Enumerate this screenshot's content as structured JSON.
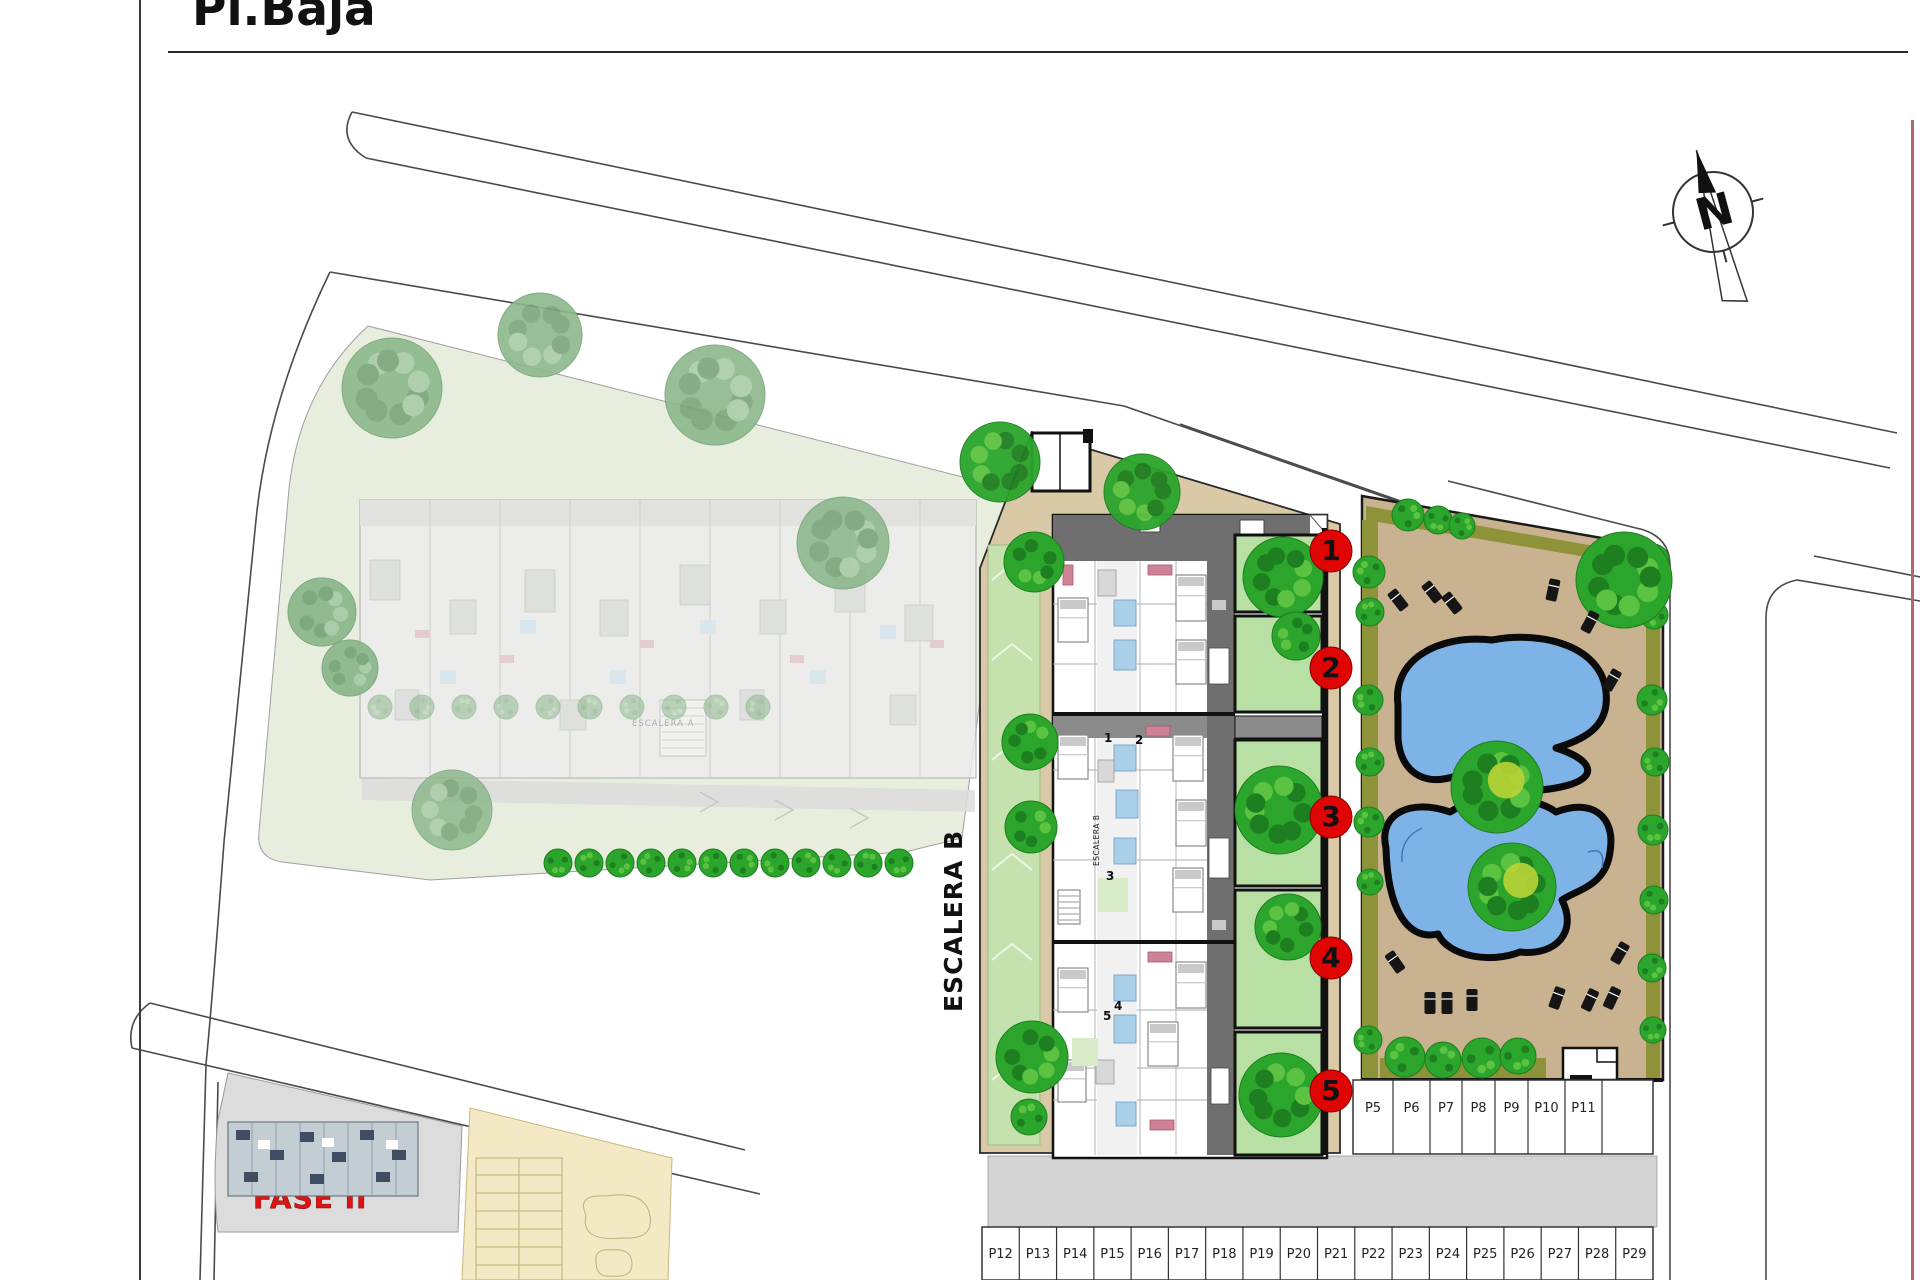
{
  "title": {
    "text": "Pl.Baja"
  },
  "plan": {
    "building_label_large": "ESCALERA B",
    "building_label_small": "ESCALERA B",
    "faded_building_label": "ESCALERA A",
    "phase_label": "FASE II",
    "compass": {
      "letter": "N"
    },
    "apartment_markers": [
      {
        "number": "1"
      },
      {
        "number": "2"
      },
      {
        "number": "3"
      },
      {
        "number": "4"
      },
      {
        "number": "5"
      }
    ],
    "unit_numbers": [
      "1",
      "2",
      "3",
      "4",
      "5"
    ],
    "parking": {
      "upper_row": [
        "P5",
        "P6",
        "P7",
        "P8",
        "P9",
        "P10",
        "P11"
      ],
      "lower_row": [
        "P12",
        "P13",
        "P14",
        "P15",
        "P16",
        "P17",
        "P18",
        "P19",
        "P20",
        "P21",
        "P22",
        "P23",
        "P24",
        "P25",
        "P26",
        "P27",
        "P28",
        "P29"
      ]
    }
  },
  "colors": {
    "marker_red": "#e00505",
    "phase_red": "#e01212",
    "pool_blue": "#7db3e6",
    "terrace_tan": "#c9b28f",
    "plot_tan": "#d9c9a7",
    "garden_green": "#b9e0a4",
    "tree_green": "#2ba52b",
    "hedge_olive": "#8e9339",
    "building_gray": "#6f6f6f",
    "road_gray": "#d4d4d4",
    "boundary_red": "#b06868"
  }
}
